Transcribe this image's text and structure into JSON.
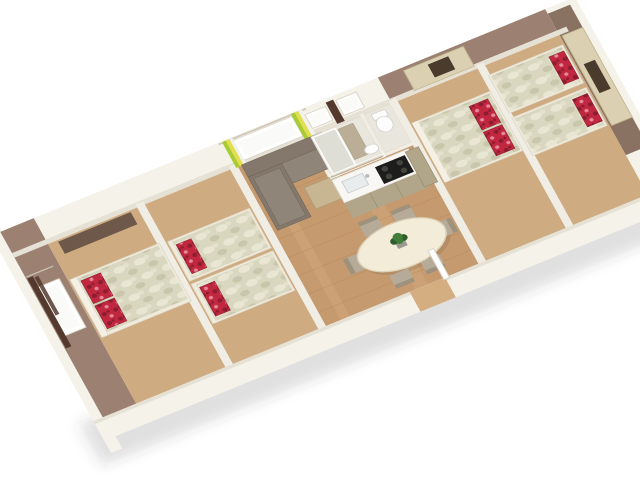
{
  "scene": {
    "title": "3D isometric floor plan render of a mobile home interior",
    "view": "isometric cutaway, white background",
    "background": "#ffffff"
  },
  "palette": {
    "background": "#ffffff",
    "wall_white": "#f5f2ea",
    "wall_shade": "#e6e1d5",
    "wall_mauve": "#9c8172",
    "wall_mauve_dark": "#8a7263",
    "partition": "#f0ede5",
    "floor_wood": "#c59a6e",
    "floor_wood_light": "#d4ad80",
    "floor_bedroom": "#cfab81",
    "tile": "#e9e6dd",
    "plank": "#a97c50",
    "quilt": "#d9d7c0",
    "quilt_spot": "#e9e7d4",
    "quilt_shade": "#c9c6ab",
    "pillow_red": "#c12840",
    "pillow_dark": "#8c1c30",
    "pillow_light": "#e4899b",
    "headboard": "#efeadb",
    "headboard_edge": "#f4f0e4",
    "dresser": "#6e584a",
    "sofa": "#84786c",
    "sofa_seat": "#908579",
    "sofa_light": "#9a9083",
    "coffee_table": "#c7b691",
    "dining_table": "#f2ecd9",
    "chair": "#b6ab99",
    "chair_dark": "#9e927d",
    "counter": "#f8f7f3",
    "kitchen_cab": "#b2a68a",
    "hob": "#1d1d1b",
    "burner": "#44443f",
    "sink": "#e8ecec",
    "cabinet_cream": "#dbd1b2",
    "cabinet_open": "#4a3b2d",
    "curtain_brown": "#54392e",
    "curtain_green": "#a8cc33",
    "curtain_yellow": "#e3de4e",
    "curtain_white": "#f2f2ec",
    "frame": "#ffffff",
    "window_glass": "#fafbf8",
    "glass": "rgba(205,210,200,0.38)",
    "plant": "#3f7d38",
    "plant_dark": "#2f5c2a",
    "pot": "#9a9a92",
    "toilet": "#fdfdfd",
    "shadow": "rgba(70,62,55,0.16)"
  },
  "rooms": {
    "structure": {
      "label": "White cutaway outer walls and partitions"
    },
    "master": {
      "label": "Master bedroom - double bed, red pillows, dresser, window with brown curtains",
      "furniture": [
        "double bed",
        "two red pillows",
        "dresser",
        "window",
        "brown curtains"
      ]
    },
    "twin_left": {
      "label": "Left twin bedroom - two single beds with red pillows",
      "furniture": [
        "single bed",
        "single bed",
        "red pillows"
      ]
    },
    "living": {
      "label": "Living area - corner sofa, coffee table, window with green striped curtains",
      "furniture": [
        "corner sofa",
        "coffee table",
        "window",
        "green curtains"
      ]
    },
    "kitchen": {
      "label": "Kitchen - counter with sink and gas hob, beige cabinets, small window",
      "furniture": [
        "counter",
        "sink",
        "gas hob",
        "cabinets",
        "tall unit",
        "window"
      ]
    },
    "bathroom": {
      "label": "Bathroom - glass shower, cabinet, washbasin, window with brown curtain",
      "furniture": [
        "shower",
        "cabinet",
        "washbasin",
        "window",
        "brown curtain"
      ]
    },
    "wc": {
      "label": "Separate WC with toilet",
      "furniture": [
        "toilet"
      ]
    },
    "dining": {
      "label": "Dining area - oval table, six chairs, green plant, entrance door",
      "furniture": [
        "oval table",
        "six chairs",
        "plant",
        "door"
      ]
    },
    "hallway": {
      "label": "Hallway with wood floor"
    },
    "double_right": {
      "label": "Right double bedroom - double bed, red floral pillows, overhead cream cabinet",
      "furniture": [
        "double bed",
        "two pillows",
        "overhead cabinet"
      ]
    },
    "twin_right": {
      "label": "Right-end twin bedroom - two single beds, red floral pillows, overhead cream cabinet",
      "furniture": [
        "single bed",
        "single bed",
        "pillows",
        "overhead cabinet"
      ]
    }
  }
}
